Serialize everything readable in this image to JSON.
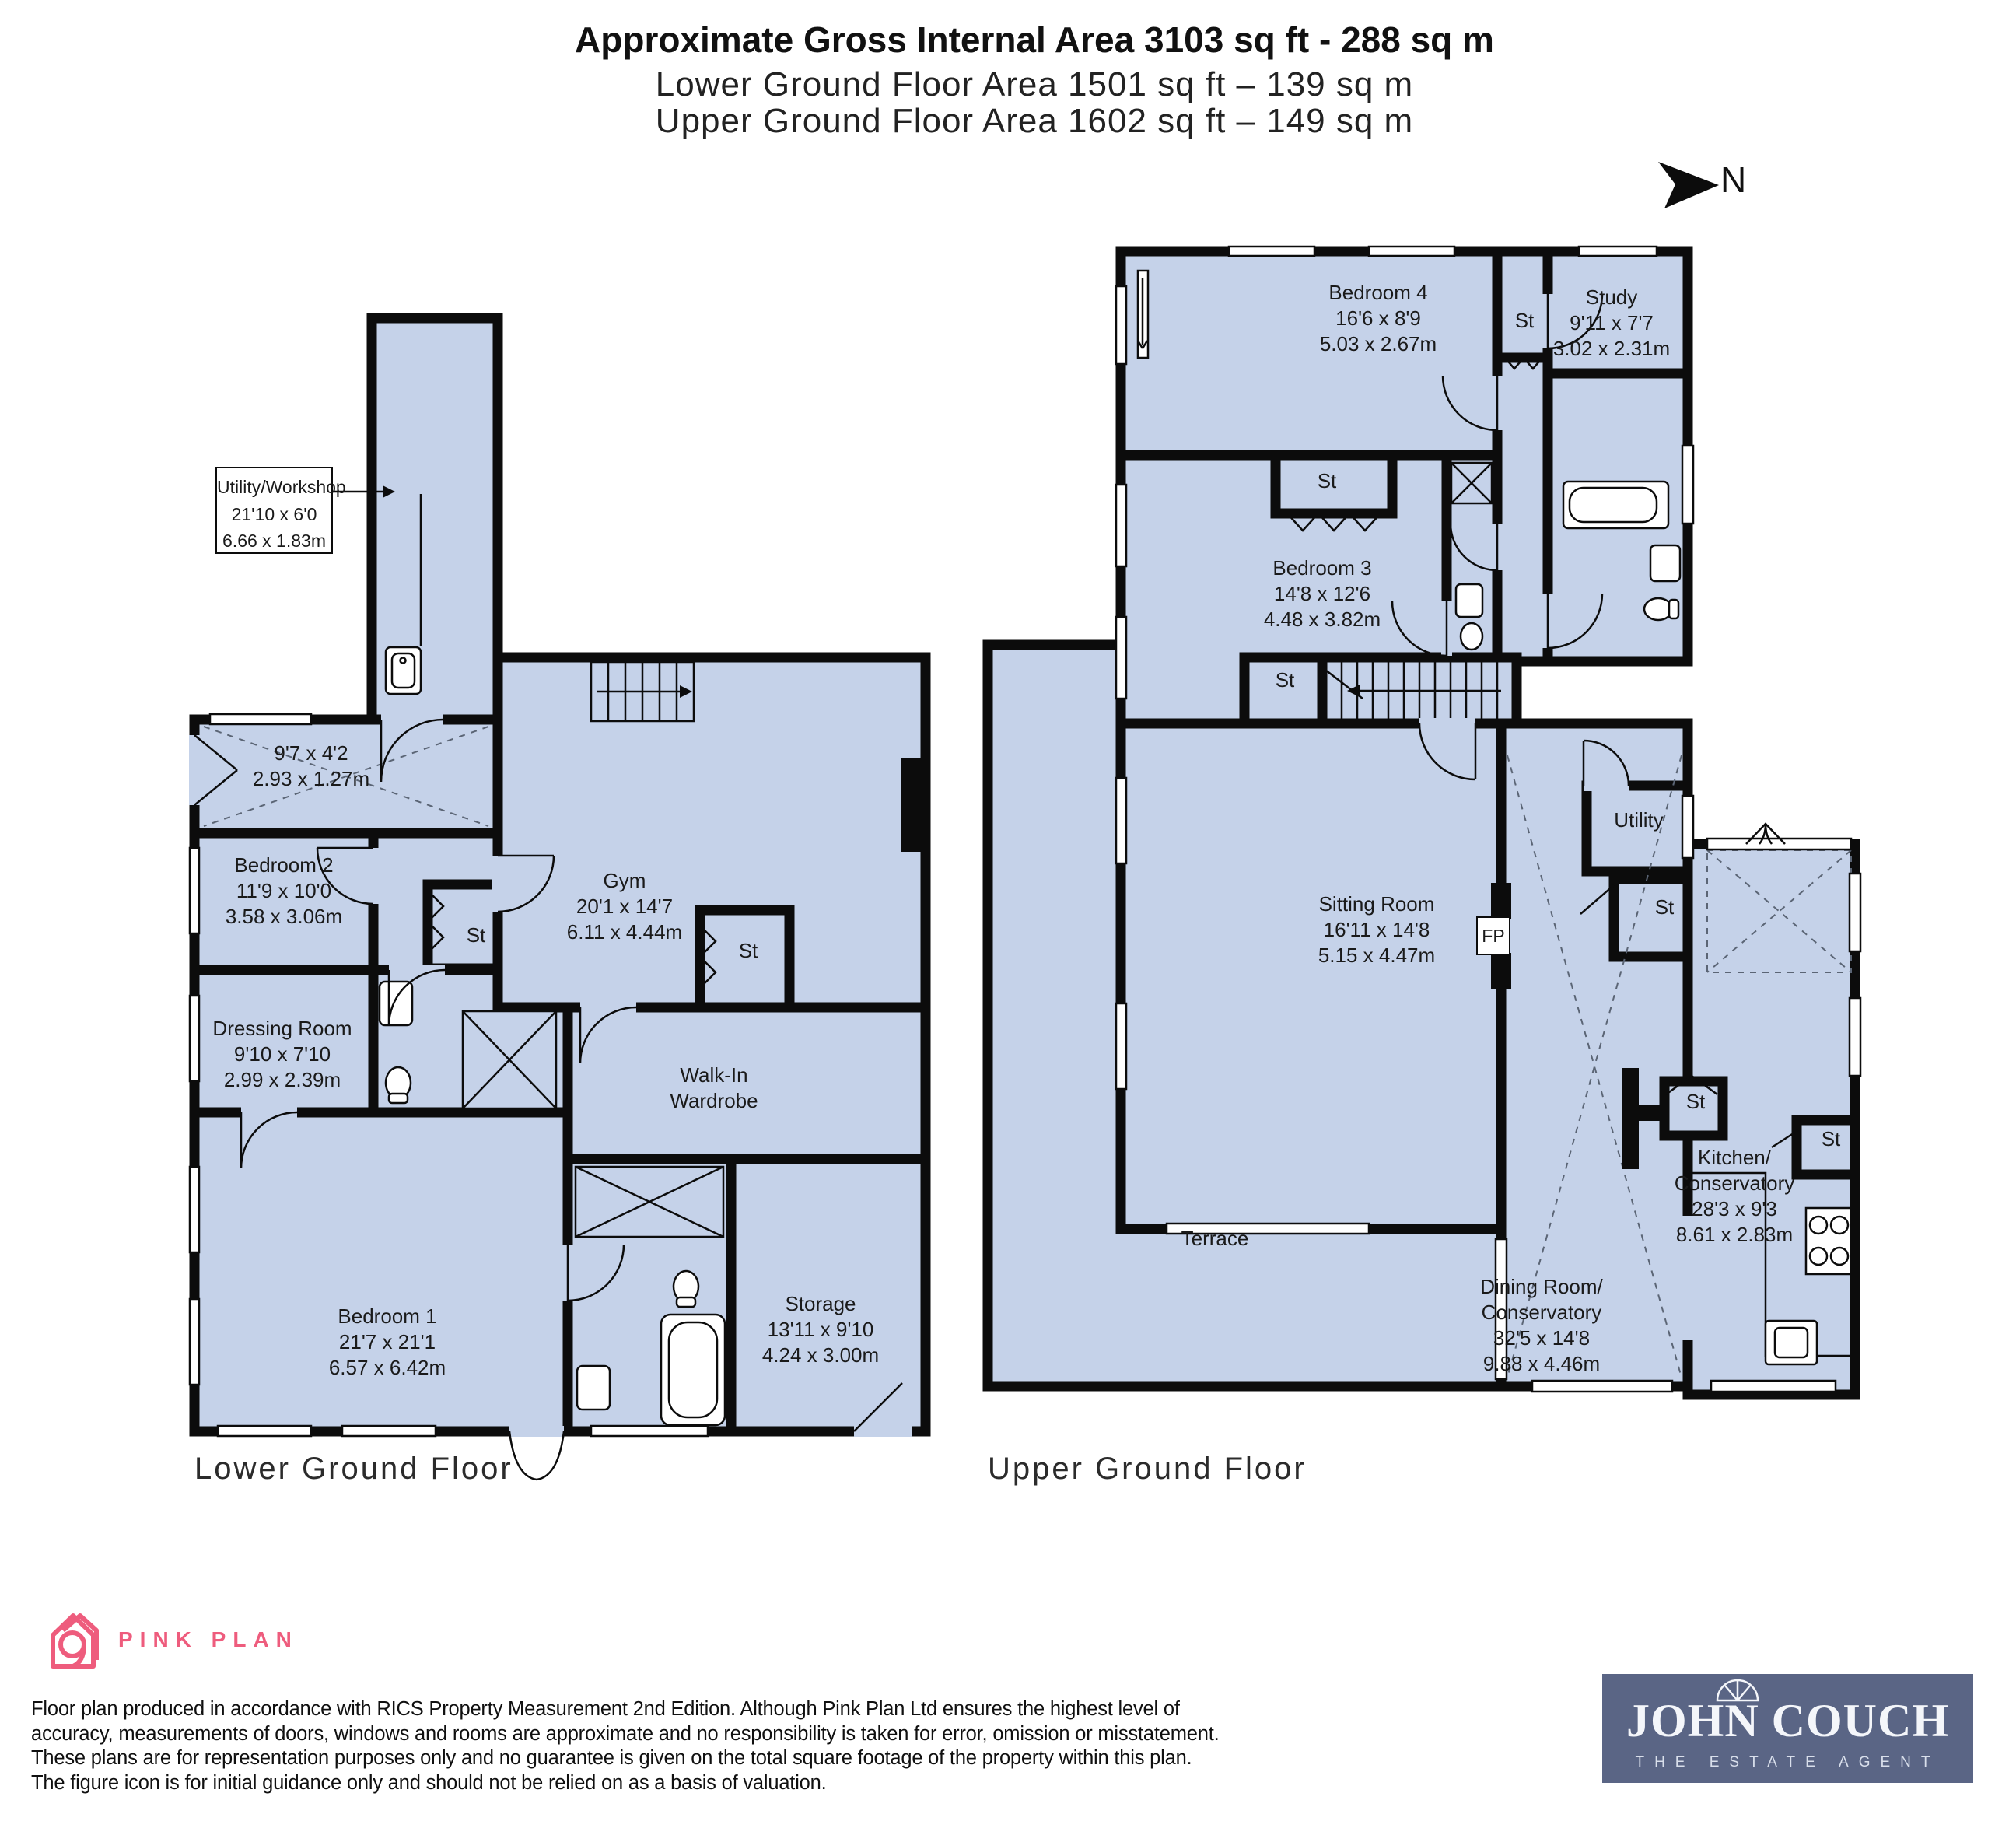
{
  "header": {
    "title_bold": "Approximate Gross Internal Area 3103 sq ft - 288 sq m",
    "subtitle_lower": "Lower Ground Floor Area 1501 sq ft – 139 sq m",
    "subtitle_upper": "Upper Ground Floor Area 1602 sq ft – 149 sq m",
    "compass_label": "N"
  },
  "colors": {
    "room_fill": "#c5d2e9",
    "wall": "#0c0c0c",
    "brand_pink": "#ee5c7d",
    "agent_background": "#5a6585"
  },
  "lower_floor": {
    "caption": "Lower Ground Floor",
    "st_label": "St",
    "rooms": {
      "utility_workshop": {
        "name": "Utility/Workshop",
        "imperial": "21'10 x 6'0",
        "metric": "6.66 x 1.83m"
      },
      "hall": {
        "imperial": "9'7 x 4'2",
        "metric": "2.93 x 1.27m"
      },
      "bedroom2": {
        "name": "Bedroom 2",
        "imperial": "11'9 x 10'0",
        "metric": "3.58 x 3.06m"
      },
      "gym": {
        "name": "Gym",
        "imperial": "20'1 x 14'7",
        "metric": "6.11 x 4.44m"
      },
      "dressing_room": {
        "name": "Dressing Room",
        "imperial": "9'10 x 7'10",
        "metric": "2.99 x 2.39m"
      },
      "walk_in_wardrobe": {
        "name": "Walk-In",
        "name2": "Wardrobe"
      },
      "bedroom1": {
        "name": "Bedroom 1",
        "imperial": "21'7 x 21'1",
        "metric": "6.57 x 6.42m"
      },
      "storage": {
        "name": "Storage",
        "imperial": "13'11 x 9'10",
        "metric": "4.24 x 3.00m"
      }
    }
  },
  "upper_floor": {
    "caption": "Upper Ground Floor",
    "st_label": "St",
    "fireplace_label": "FP",
    "rooms": {
      "bedroom4": {
        "name": "Bedroom 4",
        "imperial": "16'6 x 8'9",
        "metric": "5.03 x 2.67m"
      },
      "study": {
        "name": "Study",
        "imperial": "9'11 x 7'7",
        "metric": "3.02 x 2.31m"
      },
      "bedroom3": {
        "name": "Bedroom 3",
        "imperial": "14'8 x 12'6",
        "metric": "4.48 x 3.82m"
      },
      "sitting_room": {
        "name": "Sitting Room",
        "imperial": "16'11 x 14'8",
        "metric": "5.15 x 4.47m"
      },
      "utility": {
        "name": "Utility"
      },
      "terrace": {
        "name": "Terrace"
      },
      "dining_conservatory": {
        "name": "Dining Room/",
        "name2": "Conservatory",
        "imperial": "32'5 x 14'8",
        "metric": "9.88 x 4.46m"
      },
      "kitchen_conservatory": {
        "name": "Kitchen/",
        "name2": "Conservatory",
        "imperial": "28'3 x 9'3",
        "metric": "8.61 x 2.83m"
      }
    }
  },
  "footer": {
    "brand": "PINK PLAN",
    "disclaimer": "Floor plan produced in accordance with RICS Property Measurement 2nd Edition. Although Pink Plan Ltd ensures the highest level of accuracy, measurements of doors, windows and rooms are approximate and no responsibility is taken for error, omission or misstatement. These plans are for representation purposes only and no guarantee is given on the total square footage of the property within this plan. The figure icon is for initial guidance only and should not be relied on as a basis of valuation.",
    "agent": {
      "name": "JOHN COUCH",
      "tagline": "THE ESTATE AGENT"
    }
  }
}
